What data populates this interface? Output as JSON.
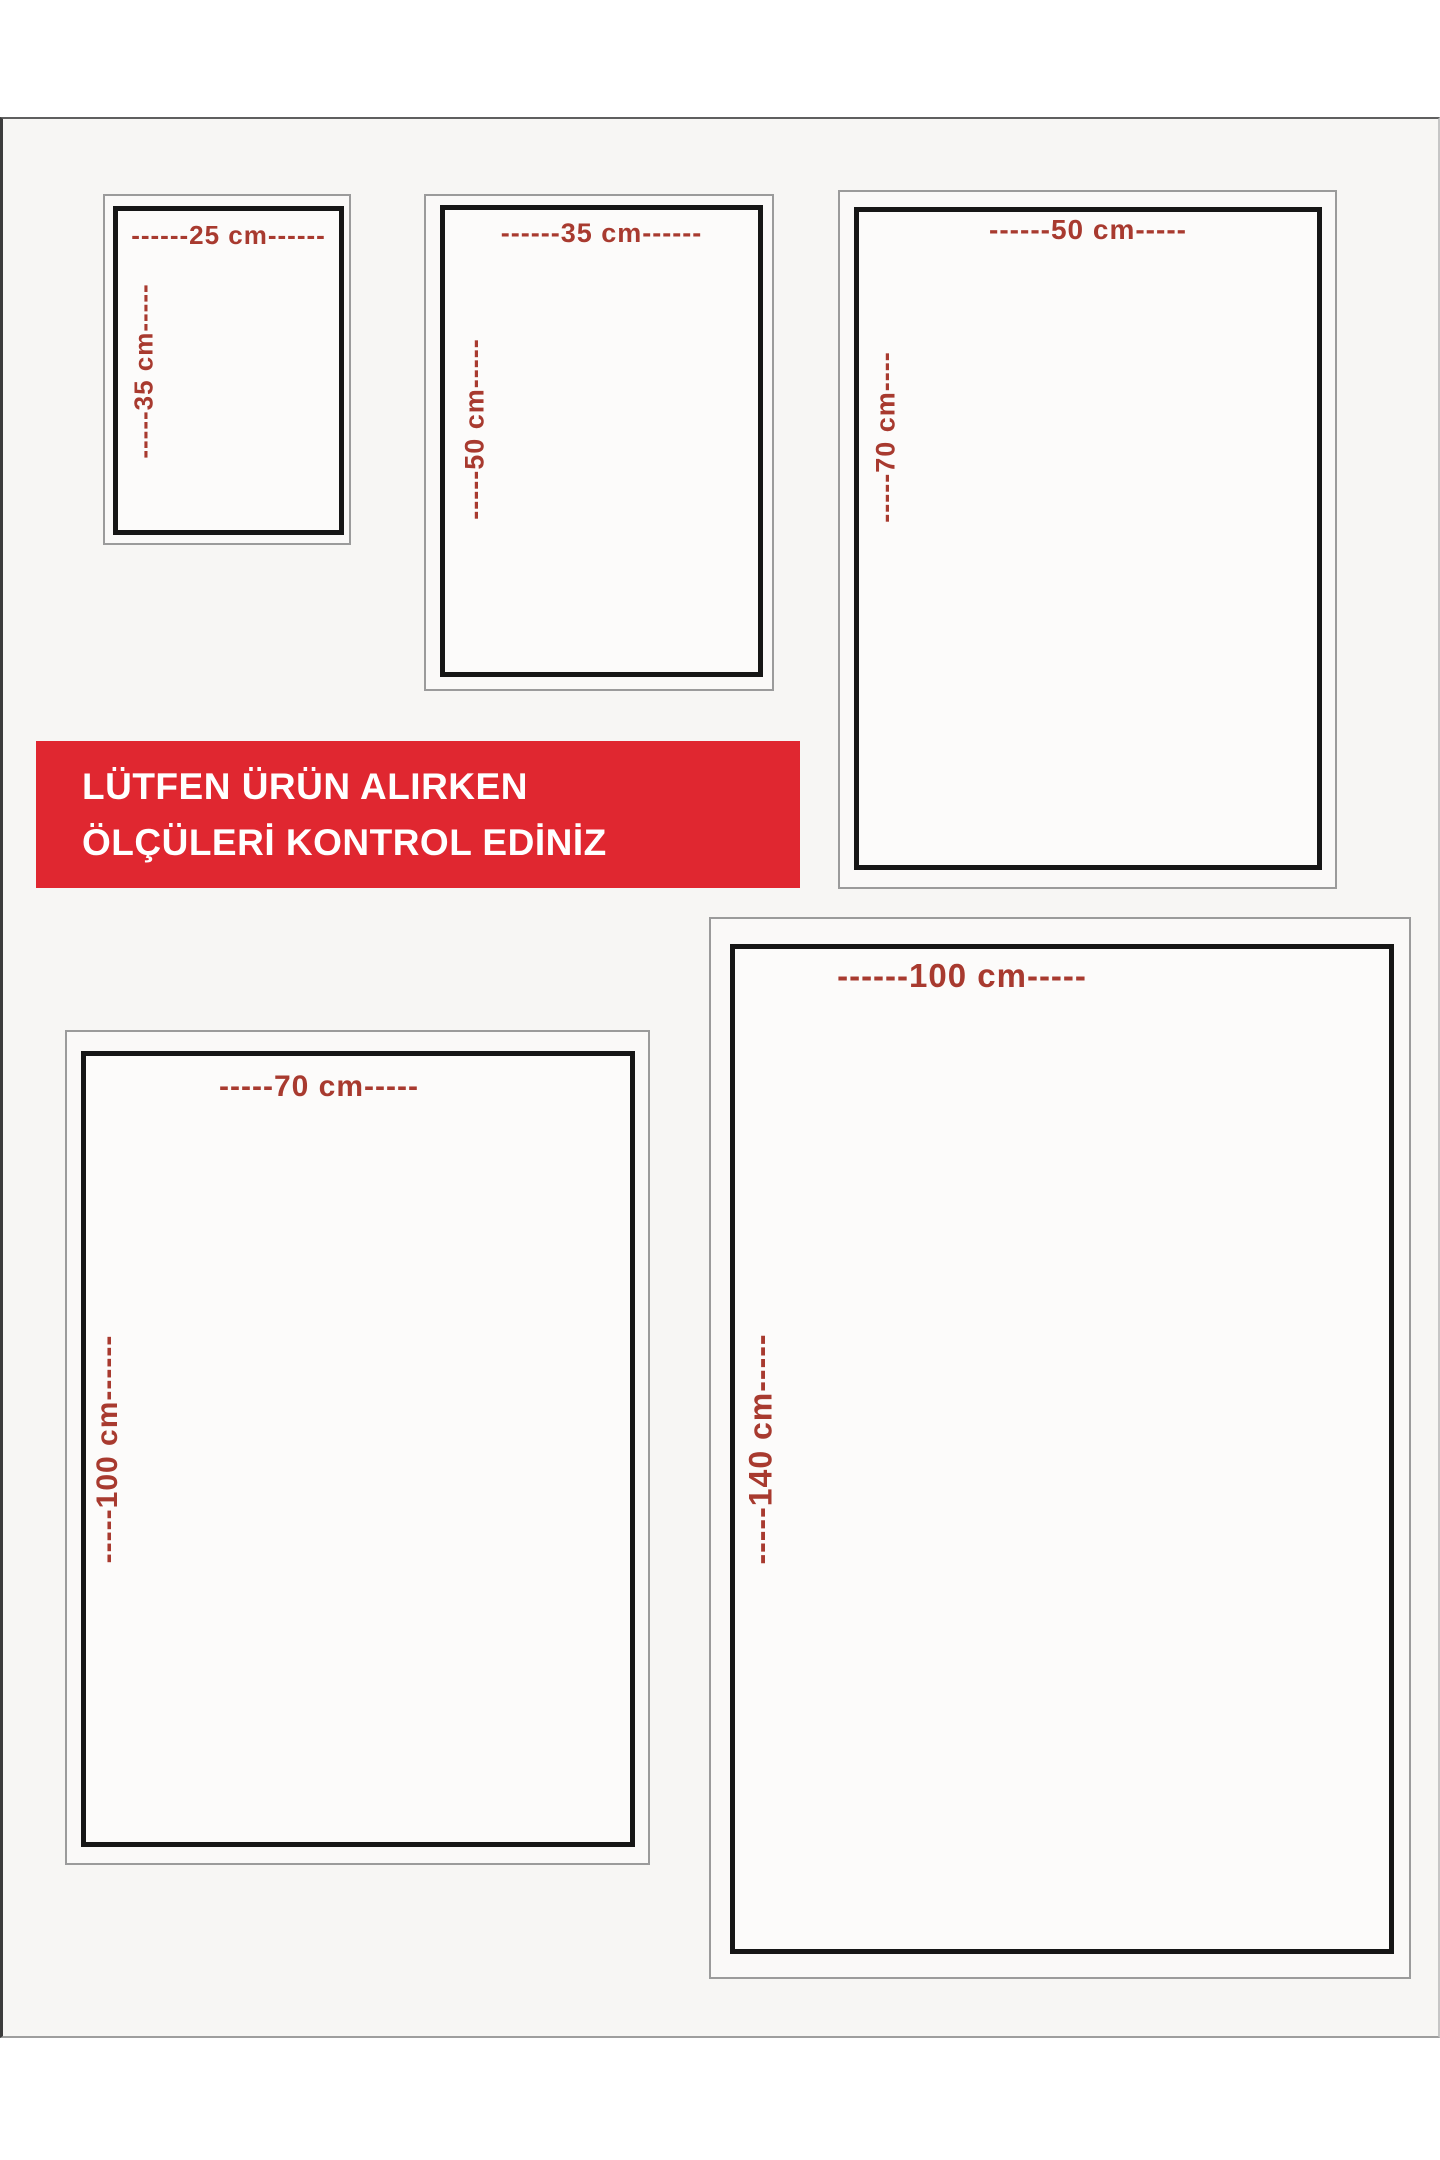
{
  "notice_banner": {
    "line1": "LÜTFEN ÜRÜN ALIRKEN",
    "line2": "ÖLÇÜLERİ KONTROL EDİNİZ",
    "background_color": "#e02730",
    "text_color": "#ffffff"
  },
  "dimension_label_color": "#a83a2f",
  "size_boxes": [
    {
      "name": "25x35",
      "width_cm": 25,
      "height_cm": 35,
      "top_label": "------25 cm------",
      "side_label": "-----35 cm-----"
    },
    {
      "name": "35x50",
      "width_cm": 35,
      "height_cm": 50,
      "top_label": "------35 cm------",
      "side_label": "-----50 cm-----"
    },
    {
      "name": "50x70",
      "width_cm": 50,
      "height_cm": 70,
      "top_label": "------50 cm-----",
      "side_label": "-----70 cm----"
    },
    {
      "name": "70x100",
      "width_cm": 70,
      "height_cm": 100,
      "top_label": "-----70 cm-----",
      "side_label": "-----100 cm------"
    },
    {
      "name": "100x140",
      "width_cm": 100,
      "height_cm": 140,
      "top_label": "------100 cm-----",
      "side_label": "-----140 cm-----"
    }
  ]
}
